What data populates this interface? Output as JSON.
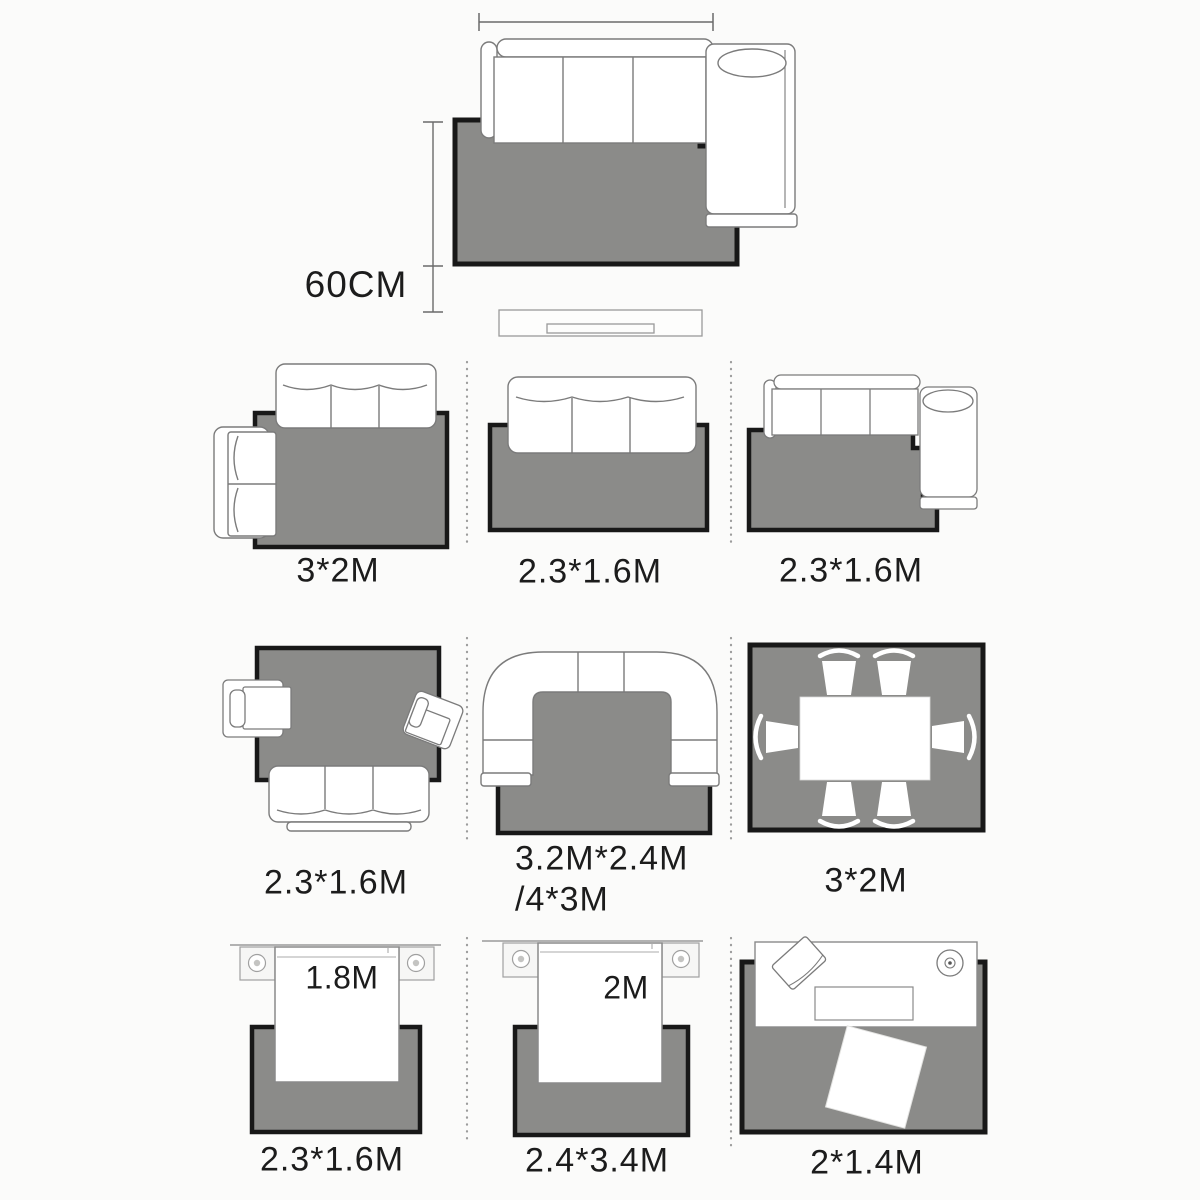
{
  "colors": {
    "background": "#fbfbfa",
    "rug_fill": "#8b8b89",
    "rug_border": "#181818",
    "furniture_outline": "#7b7b7b",
    "text": "#1c1c1c",
    "divider_dots": "#9c9c9c"
  },
  "hero": {
    "clearance": "60CM"
  },
  "grid": [
    {
      "id": "living-sofa-loveseat",
      "label": "3*2M"
    },
    {
      "id": "living-sofa-straight",
      "label": "2.3*1.6M"
    },
    {
      "id": "living-sofa-chaise",
      "label": "2.3*1.6M"
    },
    {
      "id": "living-sofa-armchairs",
      "label": "2.3*1.6M"
    },
    {
      "id": "living-u-sectional",
      "label": "3.2M*2.4M",
      "label2": "/4*3M"
    },
    {
      "id": "dining-table",
      "label": "3*2M"
    },
    {
      "id": "bedroom-1",
      "label": "2.3*1.6M",
      "furniture_size": "1.8M"
    },
    {
      "id": "bedroom-2",
      "label": "2.4*3.4M",
      "furniture_size": "2M"
    },
    {
      "id": "media-console",
      "label": "2*1.4M"
    }
  ]
}
